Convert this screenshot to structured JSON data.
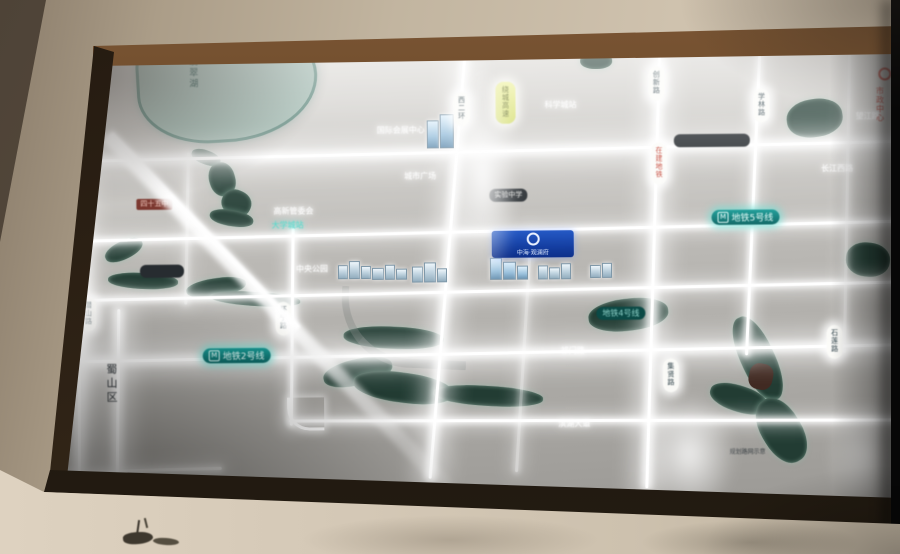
{
  "scene": {
    "description": "Photograph of a wall-mounted backlit location map (real-estate sales display), shot at an angle with strong glare streaks",
    "colors": {
      "wall_beige": "#c6b9a5",
      "frame_brown": "#5d3d22",
      "panel_gray": "#b9b7b3",
      "road_glow": "#ffffff",
      "water_dark": "#223c33",
      "lake_teal": "#a6c0b7",
      "metro_teal": "#11807c",
      "sign_blue": "#1443ae",
      "highway_yellow": "#d9e070",
      "red_accent": "#c0392b"
    }
  },
  "map": {
    "district_label": {
      "text": "蜀山区",
      "x": 42,
      "y": 322
    },
    "lake_label": {
      "text": "翡翠湖",
      "x": 128,
      "y": 16
    },
    "road_capsules": [
      {
        "text": "潜山路",
        "x": 20,
        "y": 256
      },
      {
        "text": "怀宁路",
        "x": 215,
        "y": 262
      },
      {
        "text": "西二环",
        "x": 395,
        "y": 54
      },
      {
        "text": "创新路",
        "x": 590,
        "y": 30
      },
      {
        "text": "学林路",
        "x": 695,
        "y": 53
      },
      {
        "text": "集贤路",
        "x": 602,
        "y": 322
      },
      {
        "text": "石莲路",
        "x": 766,
        "y": 290
      }
    ],
    "highway_capsule": {
      "text": "绕城高速",
      "x": 437,
      "y": 44
    },
    "construction_capsule": {
      "text": "在建地铁",
      "x": 592,
      "y": 106
    },
    "metro_labels": [
      {
        "text": "地铁5号线",
        "x": 652,
        "y": 174
      },
      {
        "text": "地铁2号线",
        "x": 142,
        "y": 308
      }
    ],
    "metro_dark_label": {
      "text": "地铁4号线",
      "x": 536,
      "y": 270
    },
    "dark_capsules": [
      {
        "text": "实验中学",
        "x": 430,
        "y": 151
      },
      {
        "text": "",
        "x": 80,
        "y": 224,
        "w": 34
      },
      {
        "text": "",
        "x": 615,
        "y": 98,
        "w": 66
      }
    ],
    "red_bar": {
      "text": "四十五中",
      "x": 77,
      "y": 158
    },
    "glow_texts": [
      {
        "text": "国际会展中心",
        "x": 318,
        "y": 86
      },
      {
        "text": "科学城站",
        "x": 486,
        "y": 62
      },
      {
        "text": "城市广场",
        "x": 345,
        "y": 132
      },
      {
        "text": "高新管委会",
        "x": 214,
        "y": 166
      },
      {
        "text": "中央公园",
        "x": 236,
        "y": 224
      },
      {
        "text": "滨湖大道",
        "x": 497,
        "y": 381
      },
      {
        "text": "祁门路",
        "x": 500,
        "y": 308
      },
      {
        "text": "长江西路",
        "x": 762,
        "y": 128
      },
      {
        "text": "望江路",
        "x": 797,
        "y": 76
      }
    ],
    "teal_station_text": {
      "text": "大学城站",
      "x": 212,
      "y": 180
    },
    "scale_note": {
      "text": "规划路网示意",
      "x": 668,
      "y": 411
    },
    "project_sign": {
      "text": "中海·观澜府",
      "x": 432,
      "y": 193,
      "w": 82,
      "h": 27
    },
    "red_site_label": {
      "text": "市政中心",
      "x": 816,
      "y": 52
    }
  }
}
